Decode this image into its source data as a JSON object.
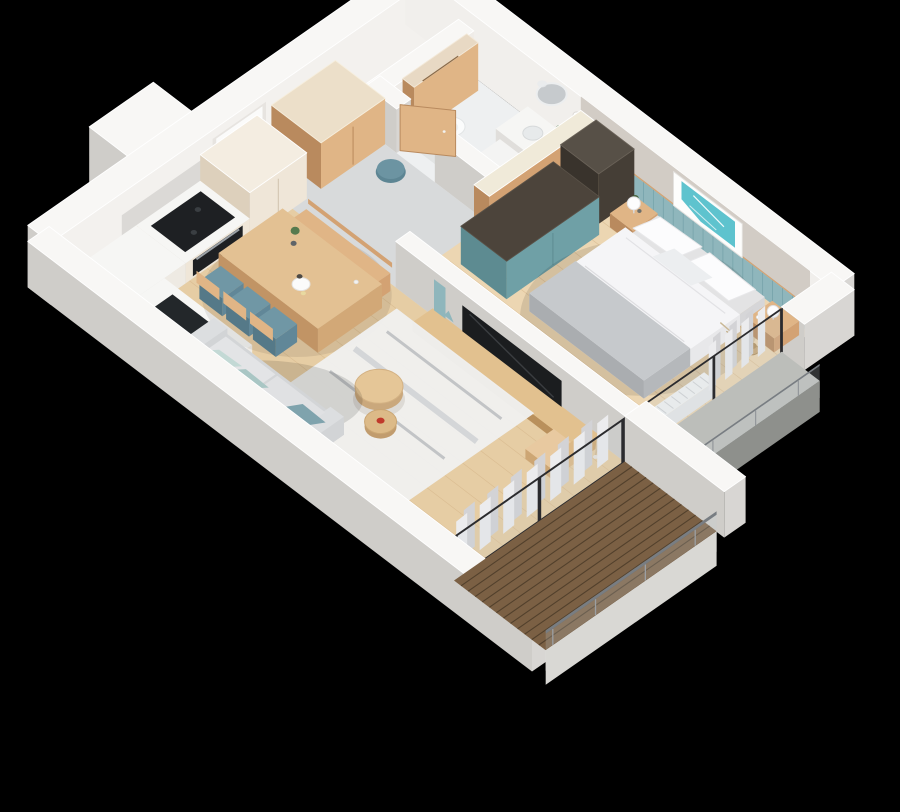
{
  "meta": {
    "type": "3d-floor-plan-render",
    "view": "isometric-dollhouse-cutaway",
    "background": "#000000"
  },
  "palette": {
    "bg": "#000000",
    "wallTop": "#f8f7f5",
    "wallEdge": "#ffffff",
    "wallInner": "#f3f1ee",
    "wallSkirt": "#d8d6d3",
    "wallShade": "#cfcdc9",
    "greigeWall": "#d2ccc5",
    "floorGrey": "#d8dadb",
    "floorBath": "#eef0f1",
    "floorWoodLiving": "#e6cda4",
    "floorWoodBedroom": "#ecd6b2",
    "woodLine": "#d4b488",
    "deckWood": "#7b6044",
    "deckGap": "#52402c",
    "creamCabinet": "#efe6d8",
    "creamCabinetSide": "#ddd0bc",
    "oak": "#d3a273",
    "oakLight": "#e0b586",
    "oakDark": "#b98a5e",
    "darkWardrobe": "#453e36",
    "darkWardrobeTop": "#575047",
    "tealCabinet": "#6fa0a6",
    "tealCabinetSide": "#5d8b91",
    "tealPanel": "#8fb6bc",
    "tealPanelLine": "#76a3aa",
    "tealChair": "#7097a5",
    "tealPouf": "#5d8593",
    "sofaBody": "#dcdee0",
    "sofaSeat": "#d3d5d7",
    "pillowMint": "#c3d9d5",
    "pillowTeal": "#a9c6c4",
    "pillowDarkTeal": "#7fa3ad",
    "rug": "#f0f0ee",
    "rugStreak": "#b7babd",
    "duvet": "#f5f5f7",
    "blanket": "#c6c9cc",
    "pillow": "#fcfcfd",
    "bedBase": "#e3e3e4",
    "artTeal": "#5ec3ce",
    "curtain": "#ececee",
    "curtainShade": "#d3d3d6",
    "frameDark": "#2b2b2e",
    "tvBlack": "#1b1d1f",
    "applianceBlack": "#1e2023",
    "steel": "#9aa0a5",
    "railGrey": "#787d82",
    "ledgeConcrete": "#bcbeba",
    "counterWhite": "#f6f6f4",
    "sinkBlack": "#23272a",
    "mirror": "#c6cacd",
    "plantGreen": "#567a4e",
    "plantDark": "#46633d",
    "basketTan": "#c9a878",
    "accentRed": "#c0392b"
  },
  "apartment": {
    "style": "scandinavian",
    "rooms": [
      {
        "name": "kitchen",
        "items": [
          "tall-cream-cabinets",
          "cooktop",
          "oven",
          "backsplash",
          "sink-counter",
          "faucet",
          "utility-shaft"
        ]
      },
      {
        "name": "hallway",
        "items": [
          "entrance-door",
          "plywood-wardrobe",
          "teal-pouf"
        ]
      },
      {
        "name": "bathroom",
        "items": [
          "wooden-door",
          "wood-clad-partition",
          "toilet",
          "vanity-sink",
          "round-mirror",
          "wall-sconce",
          "washing-machine",
          "plant"
        ]
      },
      {
        "name": "living-room",
        "items": [
          "dining-table",
          "dining-bench",
          "teal-chairs",
          "table-plant",
          "serving-tray",
          "media-console",
          "tv",
          "easel-decor",
          "rug",
          "nesting-coffee-tables",
          "sofa",
          "throw-pillows",
          "reading-chair",
          "pampas-vase",
          "curtains",
          "sliding-glass-door"
        ]
      },
      {
        "name": "bedroom",
        "items": [
          "double-bed",
          "pillows",
          "grey-throw-blanket",
          "dark-wardrobe",
          "teal-wardrobe",
          "headboard-wainscot-panels",
          "wall-art-teal-map",
          "nightstands",
          "sphere-table-lamps",
          "plant-pots",
          "wicker-basket",
          "radiator",
          "curtains",
          "window-wall"
        ]
      },
      {
        "name": "balcony",
        "items": [
          "wood-decking",
          "glass-balustrade",
          "grey-handrail",
          "side-walls"
        ]
      },
      {
        "name": "french-balcony",
        "items": [
          "concrete-ledge",
          "railing",
          "corner-pillar"
        ]
      }
    ]
  }
}
